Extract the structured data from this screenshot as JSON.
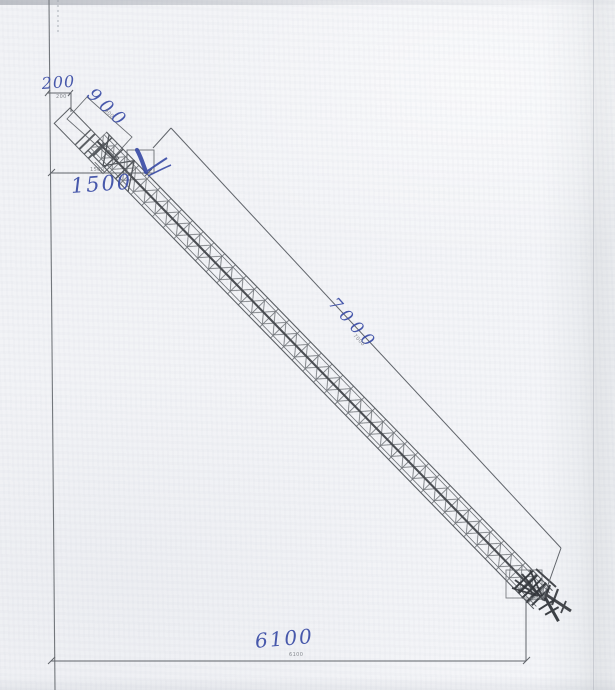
{
  "drawing": {
    "dimensions": {
      "vertical_offset": {
        "value": "200"
      },
      "head_section": {
        "value": "900"
      },
      "inlet_height": {
        "value": "1500"
      },
      "conveyor_length": {
        "value": "7000"
      },
      "horizontal_span": {
        "value": "6100"
      }
    },
    "printed_labels": {
      "vertical_offset": "200",
      "head_section": "900",
      "inlet_height": "1500",
      "conveyor_length": "7000",
      "horizontal_span": "6100"
    },
    "annotations": {
      "check_icon": "✓"
    },
    "colors": {
      "ink": "#3b4da6",
      "linework": "#5f6368",
      "paper": "#f3f4f7"
    }
  }
}
